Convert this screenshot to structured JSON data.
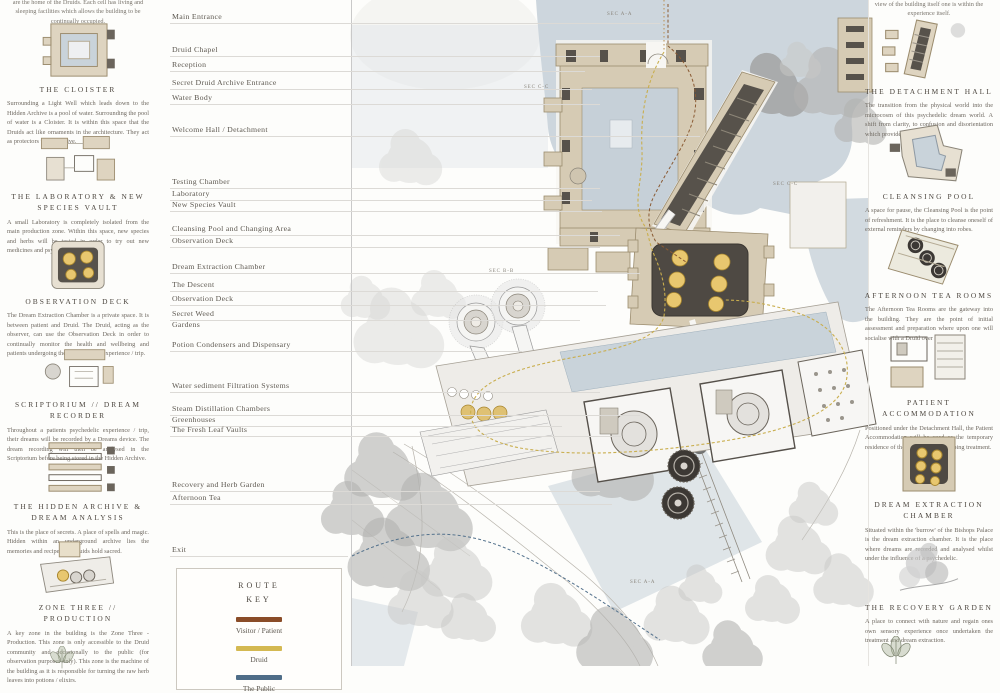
{
  "page": {
    "left_intro": "are the home of the Druids. Each cell has living and sleeping facilities which allows the building to be continually occupied.",
    "right_intro": "view of the building itself one is within the experience itself."
  },
  "left_column": {
    "sections": [
      {
        "title": "THE CLOISTER",
        "thumb": "cloister-plan",
        "body": "Surrounding a Light Well which leads down to the Hidden Archive is a pool of water. Surrounding the pool of water is a Cloister. It is within this space that the Druids act like ornaments in the architecture. They act as protectors to the archive."
      },
      {
        "title": "THE LABORATORY & NEW SPECIES VAULT",
        "thumb": "laboratory-plan",
        "body": "A small Laboratory is completely isolated from the main production zone. Within this space, new species and herbs will be tested in order to try out new medicines and psychedelics."
      },
      {
        "title": "OBSERVATION DECK",
        "thumb": "observation-deck-plan",
        "body": "The Dream Extraction Chamber is a private space. It is between patient and Druid. The Druid, acting as the observer, can use the Observation Deck in order to continually monitor the health and wellbeing and patients undergoing their psychedelic experience / trip."
      },
      {
        "title": "SCRIPTORIUM // DREAM RECORDER",
        "thumb": "scriptorium-plan",
        "body": "Throughout a patients psychedelic experience / trip, their dreams will be recorded by a Dreams device. The dream recording will then be analysed in the Scriptorium before being stored in the Hidden Archive."
      },
      {
        "title": "THE HIDDEN ARCHIVE & DREAM ANALYSIS",
        "thumb": "hidden-archive-plan",
        "body": "This is the place of secrets. A place of spells and magic. Hidden within an underground archive lies the memories and recipes the Druids hold sacred."
      },
      {
        "title": "ZONE THREE // PRODUCTION",
        "thumb": "zone-three-plan",
        "body": "A key zone in the building is the Zone Three - Production. This zone is only accessible to the Druid community and occasionally to the public (for observation purposes only). This zone is the machine of the building as it is responsible for turning the raw herb leaves into potions / elixirs."
      }
    ]
  },
  "right_column": {
    "sections": [
      {
        "title": "THE DETACHMENT HALL",
        "thumb": "detachment-hall-plan",
        "body": "The transition from the physical world into the microcosm of this psychedelic dream world. A shift from clarity, to confusion and disorientation which provides fear."
      },
      {
        "title": "CLEANSING POOL",
        "thumb": "cleansing-pool-plan",
        "body": "A space for pause, the Cleansing Pool is the point of refreshment. It is the place to cleanse oneself of external reminders by changing into robes."
      },
      {
        "title": "AFTERNOON TEA ROOMS",
        "thumb": "tea-rooms-plan",
        "body": "The Afternoon Tea Rooms are the gateway into the building. They are the point of initial assessment and preparation where upon one will socialise with a Druid over a pot of tea."
      },
      {
        "title": "PATIENT ACCOMMODATION",
        "thumb": "patient-accommodation-plan",
        "body": "Positioned under the Detachment Hall, the Patient Accommodation will be used as the temporary residence of the individuals undergoing treatment."
      },
      {
        "title": "DREAM EXTRACTION CHAMBER",
        "thumb": "dream-extraction-plan",
        "body": "Situated within the 'burrow' of the Bishops Palace is the dream extraction chamber. It is the place where dreams are recorded and analysed whilst under the influence of a psychedelic."
      },
      {
        "title": "THE RECOVERY GARDEN",
        "thumb": "recovery-garden-plan",
        "body": "A place to connect with nature and regain ones own sensory experience once undertaken the treatment and dream extraction."
      }
    ]
  },
  "map_labels": [
    "Main Entrance",
    "Druid Chapel",
    "Reception",
    "Secret Druid Archive Entrance",
    "Water Body",
    "Welcome Hall / Detachment",
    "Testing Chamber",
    "Laboratory",
    "New Species Vault",
    "Cleansing Pool and Changing Area",
    "Observation Deck",
    "Dream Extraction Chamber",
    "The Descent",
    "Observation Deck",
    "Secret Weed\nGardens",
    "Potion Condensers and Dispensary",
    "Water sediment Filtration Systems",
    "Steam Distillation Chambers",
    "Greenhouses",
    "The Fresh Leaf Vaults",
    "Recovery and Herb Garden",
    "Afternoon Tea",
    "Exit"
  ],
  "map": {
    "section_markers": [
      "SEC A-A",
      "SEC C-C",
      "SEC C-C",
      "SEC B-B",
      "SEC A-A"
    ]
  },
  "legend": {
    "title": "ROUTE KEY",
    "entries": [
      {
        "label": "Visitor / Patient",
        "color": "#8a4c28"
      },
      {
        "label": "Druid",
        "color": "#d4b952"
      },
      {
        "label": "The Public",
        "color": "#4f6d88"
      }
    ]
  }
}
